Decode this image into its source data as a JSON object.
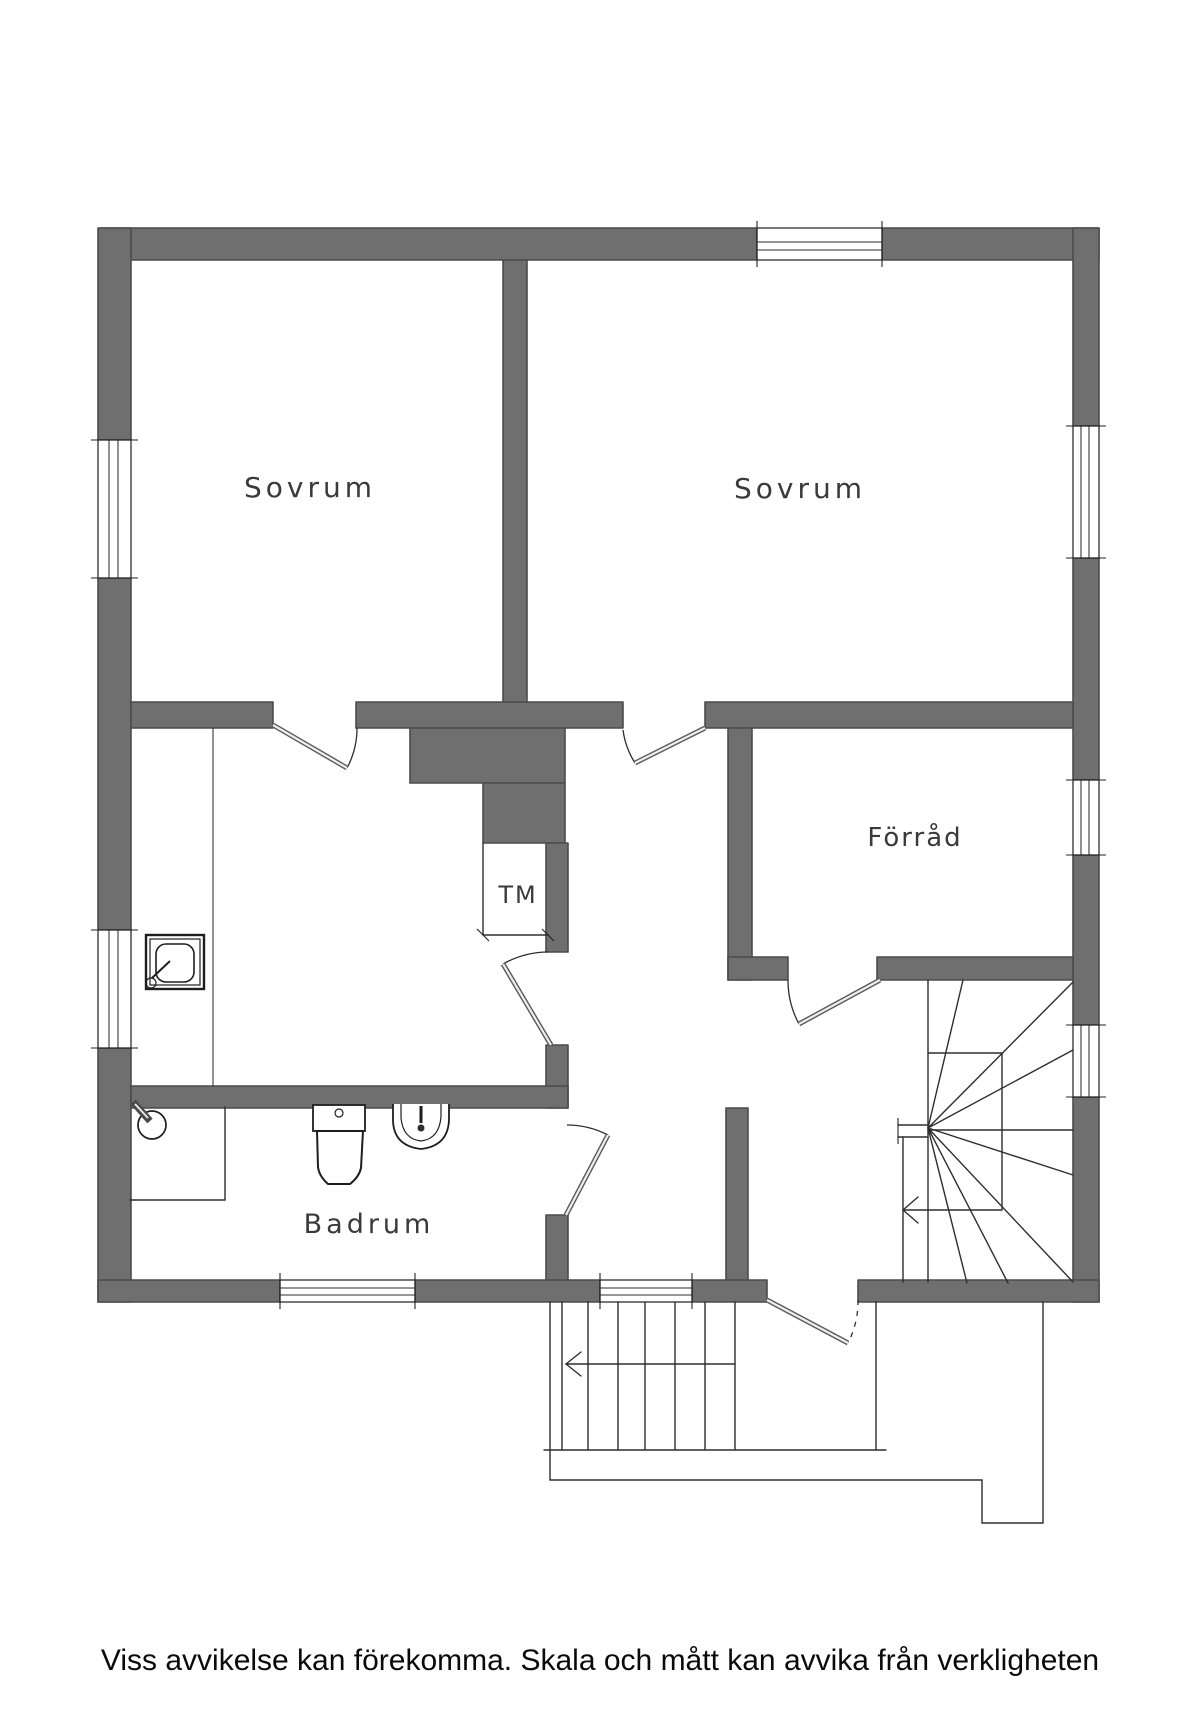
{
  "plan": {
    "rooms": [
      {
        "key": "sovrum-left",
        "label": "Sovrum"
      },
      {
        "key": "sovrum-right",
        "label": "Sovrum"
      },
      {
        "key": "forrad",
        "label": "Förråd"
      },
      {
        "key": "badrum",
        "label": "Badrum"
      }
    ],
    "appliances": [
      {
        "key": "tm-closet",
        "label": "TM"
      }
    ],
    "features": {
      "windows": 8,
      "doors": 6,
      "interior_stair": "winder-staircase",
      "exterior_stair": "entrance-steps",
      "bathroom_fixtures": [
        "shower",
        "toilet",
        "sink"
      ]
    }
  },
  "footer": {
    "disclaimer": "Viss avvikelse kan förekomma. Skala och mått kan avvika från verkligheten"
  },
  "colors": {
    "wall": "#6f6f6f",
    "wall_edge": "#4c4c4c",
    "line": "#2e2e2e",
    "label": "#3a3a3a",
    "background": "#ffffff"
  }
}
